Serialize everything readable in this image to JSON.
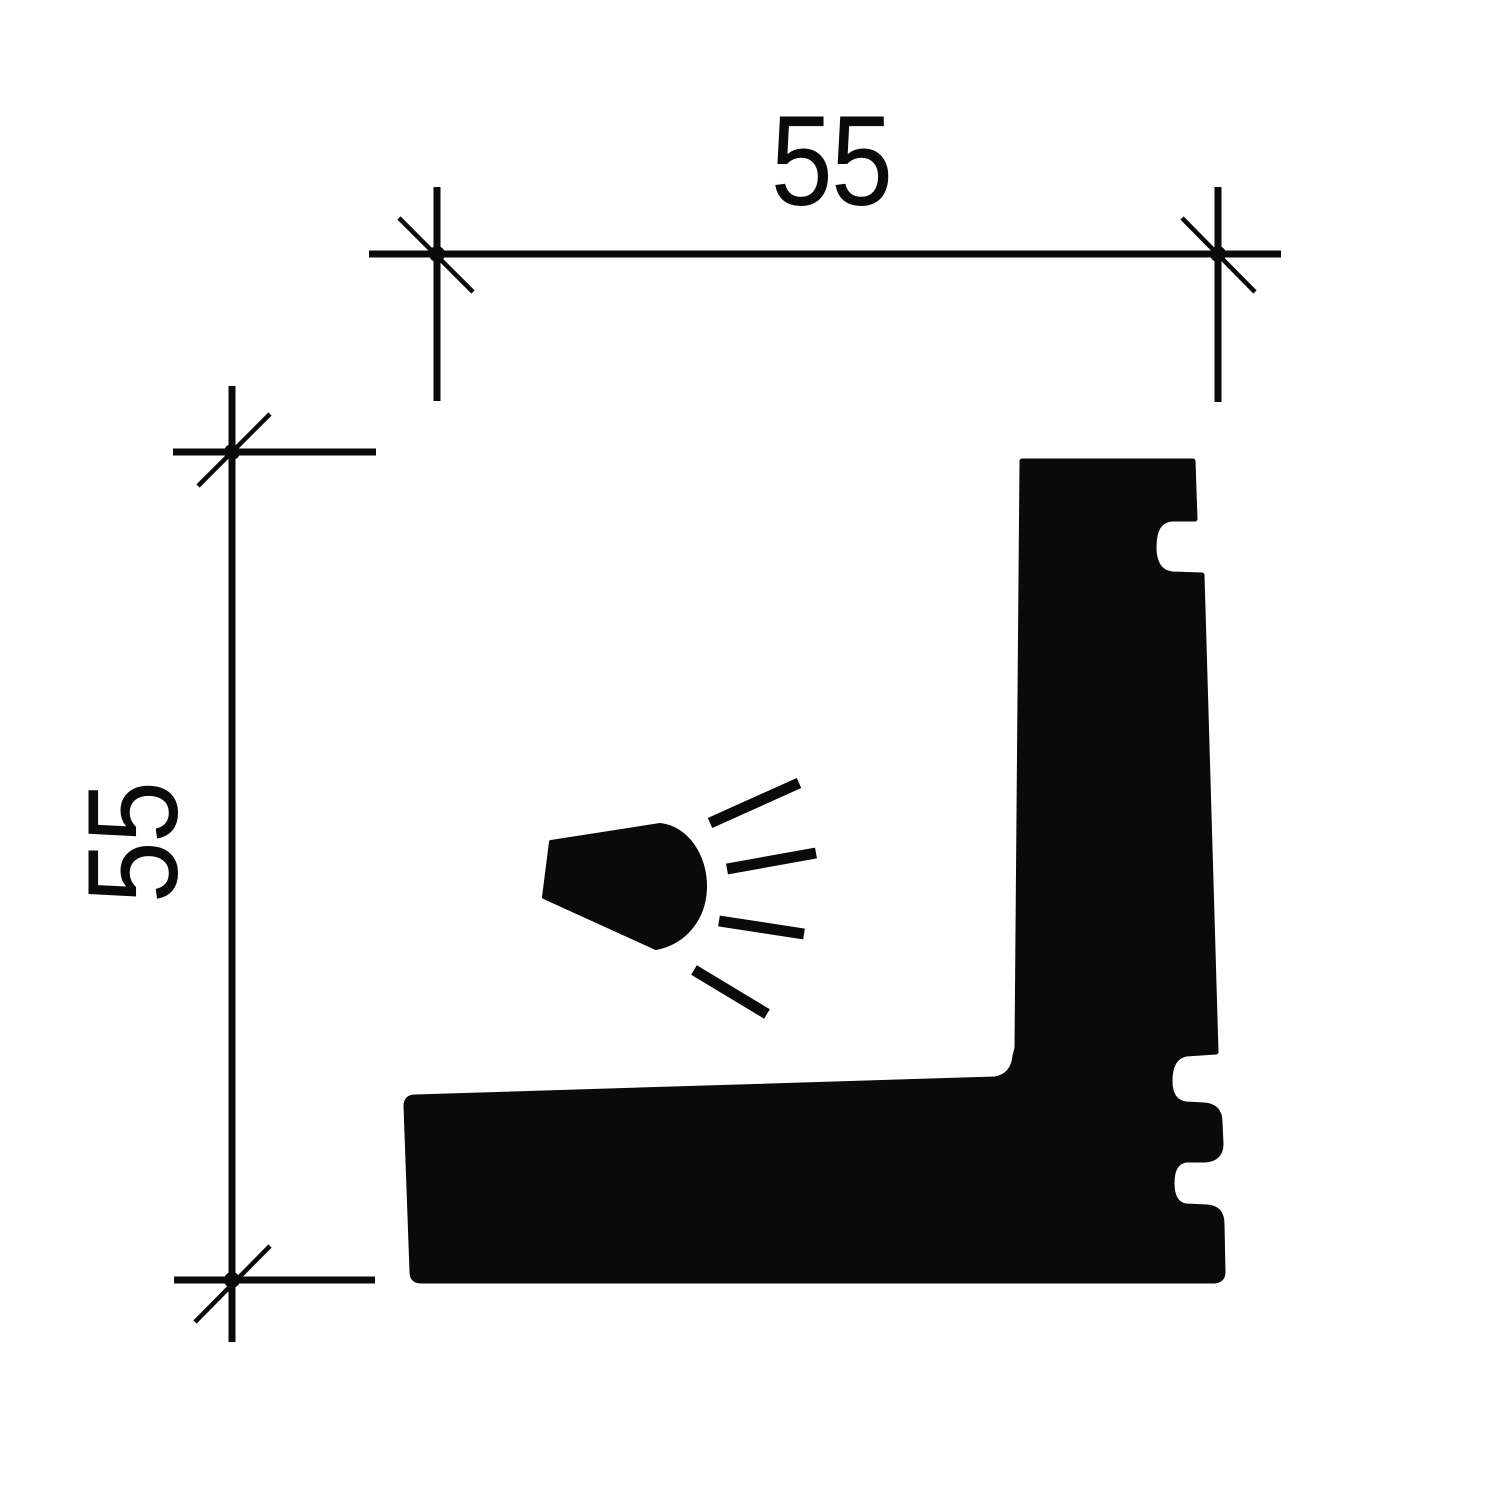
{
  "drawing": {
    "ink_color": "#0a0a0a",
    "background_color": "#ffffff",
    "width_dimension": {
      "label": "55"
    },
    "height_dimension": {
      "label": "55"
    },
    "icons": {
      "light": "light-icon"
    }
  }
}
